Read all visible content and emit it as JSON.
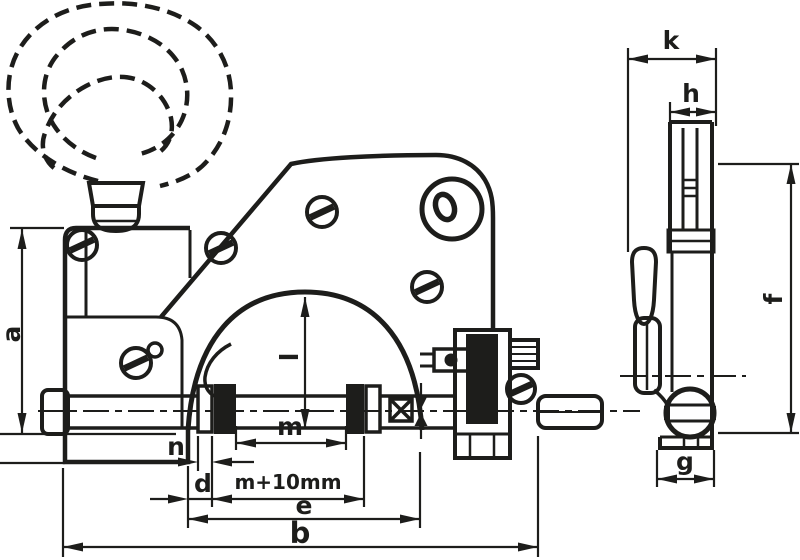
{
  "colors": {
    "ink": "#1d1d1b",
    "background": "#ffffff"
  },
  "drawing": {
    "dimensions": {
      "a": {
        "label": "a"
      },
      "l": {
        "label": "l"
      },
      "m": {
        "label": "m"
      },
      "n": {
        "label": "n"
      },
      "d": {
        "label": "d"
      },
      "m_plus_10": {
        "label": "m+10mm"
      },
      "e": {
        "label": "e"
      },
      "b": {
        "label": "b"
      },
      "k": {
        "label": "k"
      },
      "h": {
        "label": "h"
      },
      "f": {
        "label": "f"
      },
      "g": {
        "label": "g"
      }
    }
  }
}
